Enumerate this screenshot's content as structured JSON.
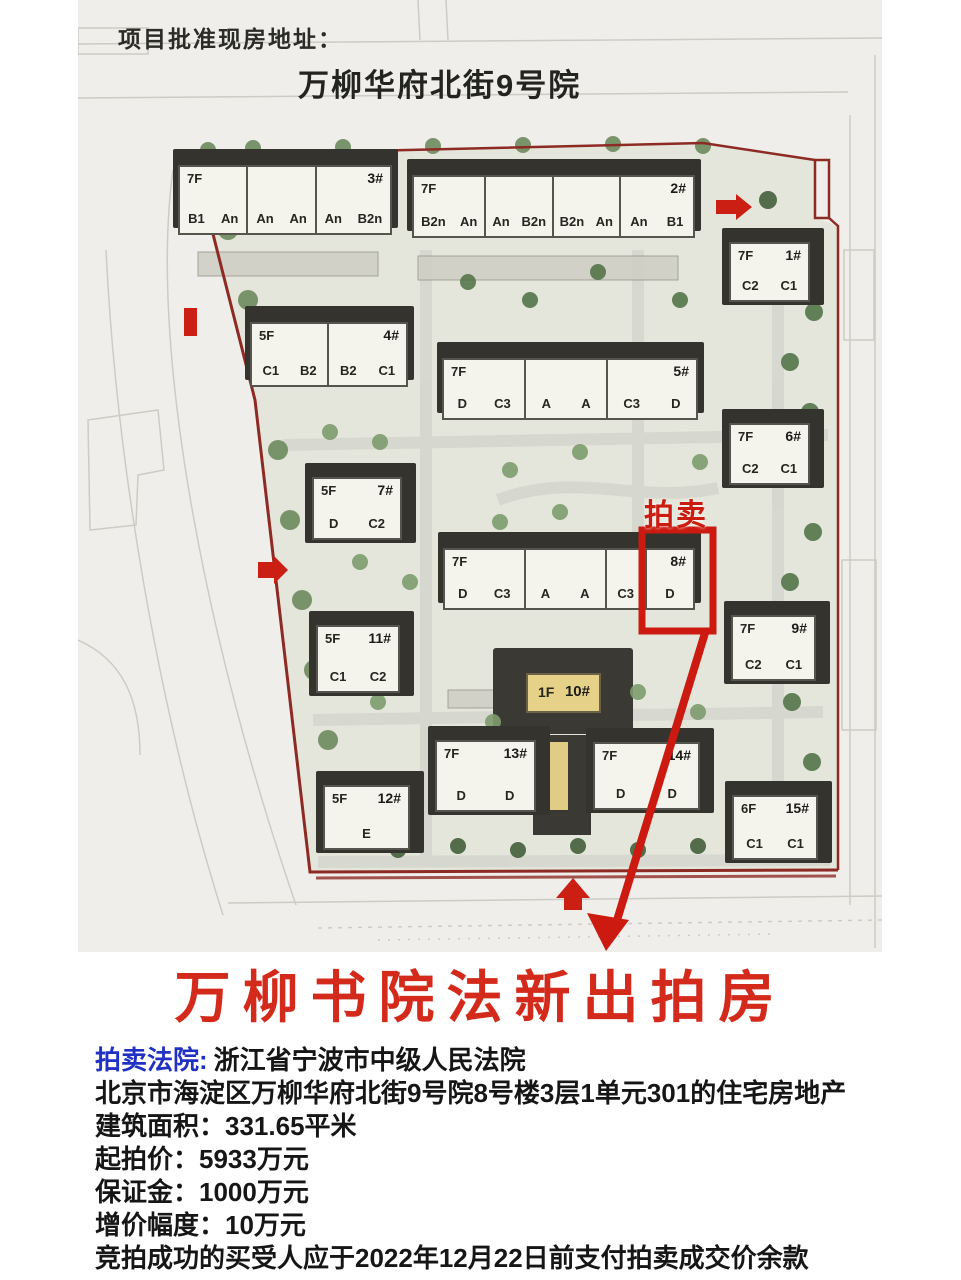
{
  "page": {
    "header_label": "项目批准现房地址：",
    "compound_name": "万柳华府北街9号院"
  },
  "map": {
    "auction_tag": "拍卖",
    "buildings": [
      {
        "id": "3#",
        "floors": "7F",
        "sections": [
          [
            "B1",
            "An"
          ],
          [
            "An",
            "An"
          ],
          [
            "An",
            "B2n"
          ]
        ]
      },
      {
        "id": "2#",
        "floors": "7F",
        "sections": [
          [
            "B2n",
            "An"
          ],
          [
            "An",
            "B2n"
          ],
          [
            "B2n",
            "An"
          ],
          [
            "An",
            "B1"
          ]
        ]
      },
      {
        "id": "1#",
        "floors": "7F",
        "sections": [
          [
            "C2",
            "C1"
          ]
        ]
      },
      {
        "id": "4#",
        "floors": "5F",
        "sections": [
          [
            "C1",
            "B2"
          ],
          [
            "B2",
            "C1"
          ]
        ]
      },
      {
        "id": "5#",
        "floors": "7F",
        "sections": [
          [
            "D",
            "C3"
          ],
          [
            "A",
            "A"
          ],
          [
            "C3",
            "D"
          ]
        ]
      },
      {
        "id": "6#",
        "floors": "7F",
        "sections": [
          [
            "C2",
            "C1"
          ]
        ]
      },
      {
        "id": "7#",
        "floors": "5F",
        "sections": [
          [
            "D",
            "C2"
          ]
        ]
      },
      {
        "id": "8#",
        "floors": "7F",
        "sections": [
          [
            "D",
            "C3"
          ],
          [
            "A",
            "A"
          ],
          [
            "C3"
          ],
          [
            "D"
          ]
        ]
      },
      {
        "id": "9#",
        "floors": "7F",
        "sections": [
          [
            "C2",
            "C1"
          ]
        ]
      },
      {
        "id": "11#",
        "floors": "5F",
        "sections": [
          [
            "C1",
            "C2"
          ]
        ]
      },
      {
        "id": "10#",
        "floors": "1F",
        "sections": []
      },
      {
        "id": "13#",
        "floors": "7F",
        "sections": [
          [
            "D",
            "D"
          ]
        ]
      },
      {
        "id": "14#",
        "floors": "7F",
        "sections": [
          [
            "D",
            "D"
          ]
        ]
      },
      {
        "id": "12#",
        "floors": "5F",
        "sections": [
          [
            "E"
          ]
        ]
      },
      {
        "id": "15#",
        "floors": "6F",
        "sections": [
          [
            "C1",
            "C1"
          ]
        ]
      }
    ]
  },
  "headline": "万柳书院法新出拍房",
  "auction_info": {
    "court_label": "拍卖法院:",
    "court_value": "浙江省宁波市中级人民法院",
    "property_line": "北京市海淀区万柳华府北街9号院8号楼3层1单元301的住宅房地产",
    "area_line": "建筑面积：331.65平米",
    "start_price_line": "起拍价：5933万元",
    "deposit_line": "保证金：1000万元",
    "increment_line": "增价幅度：10万元",
    "payment_line": "竞拍成功的买受人应于2022年12月22日前支付拍卖成交价余款"
  },
  "colors": {
    "accent_red": "#cc1f14",
    "boundary_red": "#8e2a24",
    "court_blue": "#2131c4",
    "building_yellow": "#e6d188"
  }
}
